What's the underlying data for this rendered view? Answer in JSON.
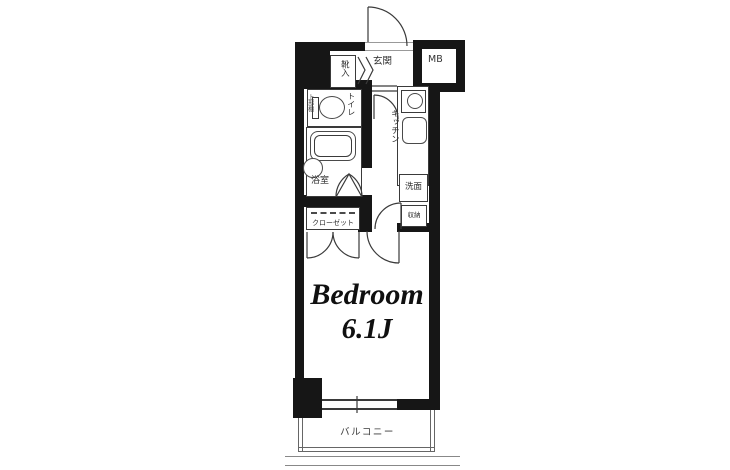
{
  "title": "1K apartment floor plan",
  "colors": {
    "wall": "#161616",
    "line": "#3a3a3a",
    "balcony_line": "#777777",
    "background": "#ffffff"
  },
  "labels": {
    "entrance": "玄関",
    "shoe_cabinet": "靴入",
    "meter_box": "MB",
    "toilet": "トイレ",
    "upper_shelf": "上部棚",
    "kitchen": "キッチン",
    "bathroom": "浴室",
    "washroom": "洗面",
    "storage": "収納",
    "closet": "クローゼット",
    "balcony": "バルコニー"
  },
  "bedroom": {
    "name": "Bedroom",
    "size": "6.1J"
  }
}
